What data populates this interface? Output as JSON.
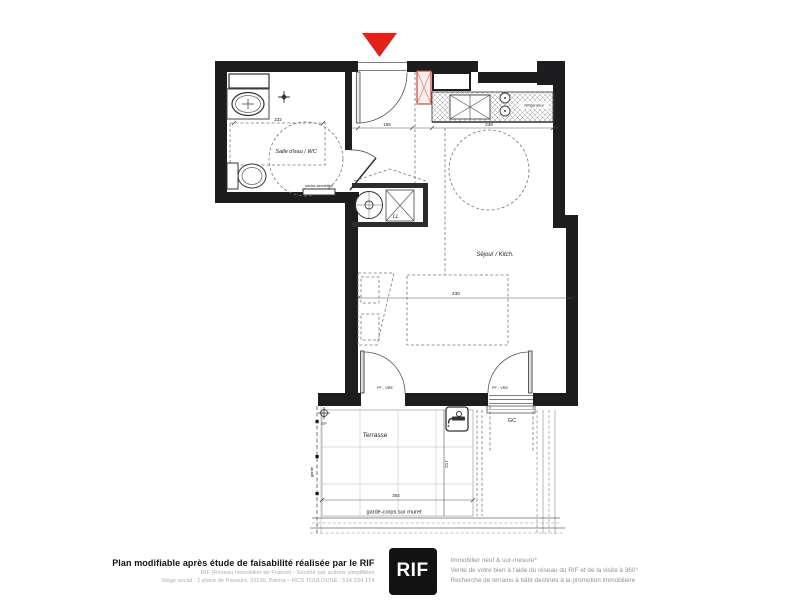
{
  "plan": {
    "rooms": {
      "bathroom": "Salle d'eau / WC",
      "living": "Séjour / Kitch.",
      "terrace": "Terrasse"
    },
    "fixtures": {
      "towel_dryer": "sèche-serviettes",
      "washing_machine": "LL",
      "fridge": "réfrigérateur"
    },
    "openings": {
      "left_door": "PF - VRE",
      "right_door": "PF - VRE",
      "railing": "GC"
    },
    "terrace_marks": {
      "drain": "EP",
      "railing_side": "garde",
      "railing_bottom": "garde-corps sur muret"
    },
    "dimensions": {
      "bathroom_width": "232",
      "entry_width": "155",
      "kitchen_width": "249",
      "living_width": "430",
      "terrace_depth": "217",
      "terrace_width": "304"
    },
    "colors": {
      "wall": "#1d1d1f",
      "entrance_arrow": "#e3211a",
      "tech_box": "#c0392b"
    }
  },
  "footer": {
    "title": "Plan modifiable après étude de faisabilité réalisée par le RIF",
    "company_line1": "RIF (Réseau Immobilier de France) - Société par actions simplifiées",
    "company_line2": "Siège social : 1 place de Pavaurs, 31130, Balma – RCS TOULOUSE : 534 234 174",
    "logo": "RIF",
    "tagline1": "Immobilier neuf & sur-mesure*",
    "tagline2": "Vente de votre bien à l'aide du réseau du RIF et de la visite à 360°",
    "tagline3": "Recherche de terrains à bâtir destinés à la promotion immobilière"
  }
}
